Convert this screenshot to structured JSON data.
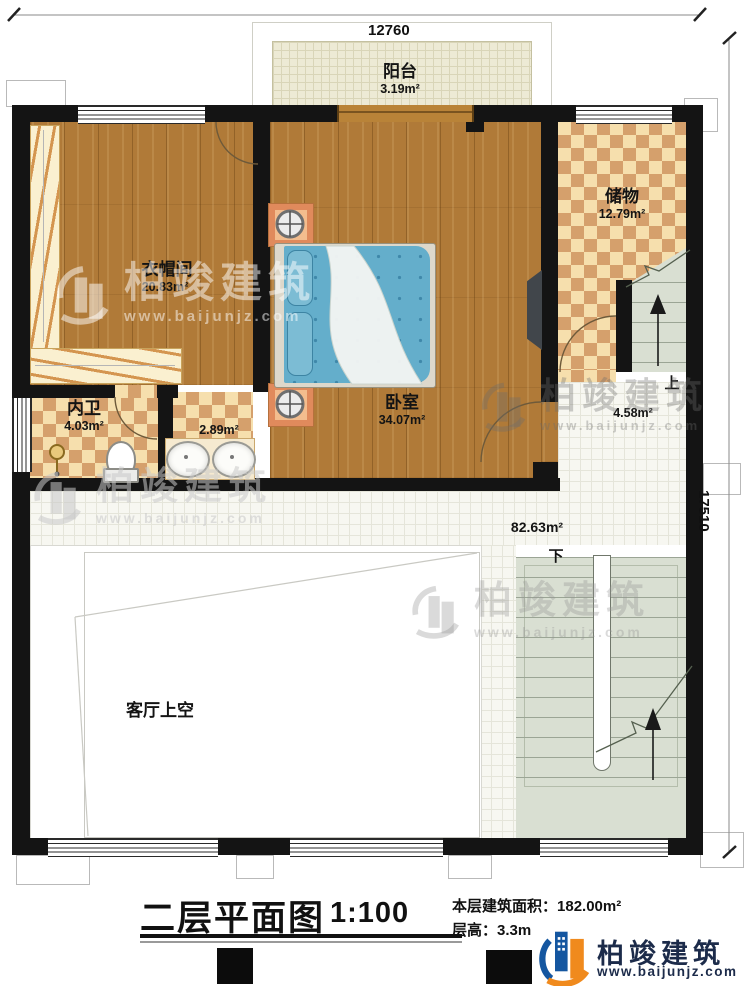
{
  "dimensions": {
    "top": "12760",
    "right": "17510"
  },
  "rooms": {
    "balcony": {
      "name": "阳台",
      "area": "3.19m²"
    },
    "closet": {
      "name": "衣帽间",
      "area": "20.83m²"
    },
    "bedroom": {
      "name": "卧室",
      "area": "34.07m²"
    },
    "storage": {
      "name": "储物",
      "area": "12.79m²"
    },
    "bathroom": {
      "name": "内卫",
      "area": "4.03m²"
    },
    "vanity": {
      "area": "2.89m²"
    },
    "stair_landing": {
      "area": "4.58m²"
    },
    "hallway": {
      "area": "82.63m²"
    },
    "living_void": {
      "name": "客厅上空"
    }
  },
  "stairs": {
    "up_label": "上",
    "down_label": "下"
  },
  "title_block": {
    "title": "二层平面图",
    "scale": "1:100",
    "floor_area_label": "本层建筑面积：",
    "floor_area_value": "182.00m²",
    "floor_height_label": "层高：",
    "floor_height_value": "3.3m"
  },
  "brand": {
    "name": "柏竣建筑",
    "url": "www.baijunjz.com"
  },
  "colors": {
    "wall": "#141414",
    "wood": "#b07a38",
    "checker_light": "#f6dfad",
    "checker_dark": "#d5a06c",
    "bed_blue": "#64aecb",
    "stair_green": "#d9dfd2",
    "accent_orange": "#f08a1d",
    "accent_blue": "#1456a0",
    "brand_navy": "#1c2b4a"
  }
}
